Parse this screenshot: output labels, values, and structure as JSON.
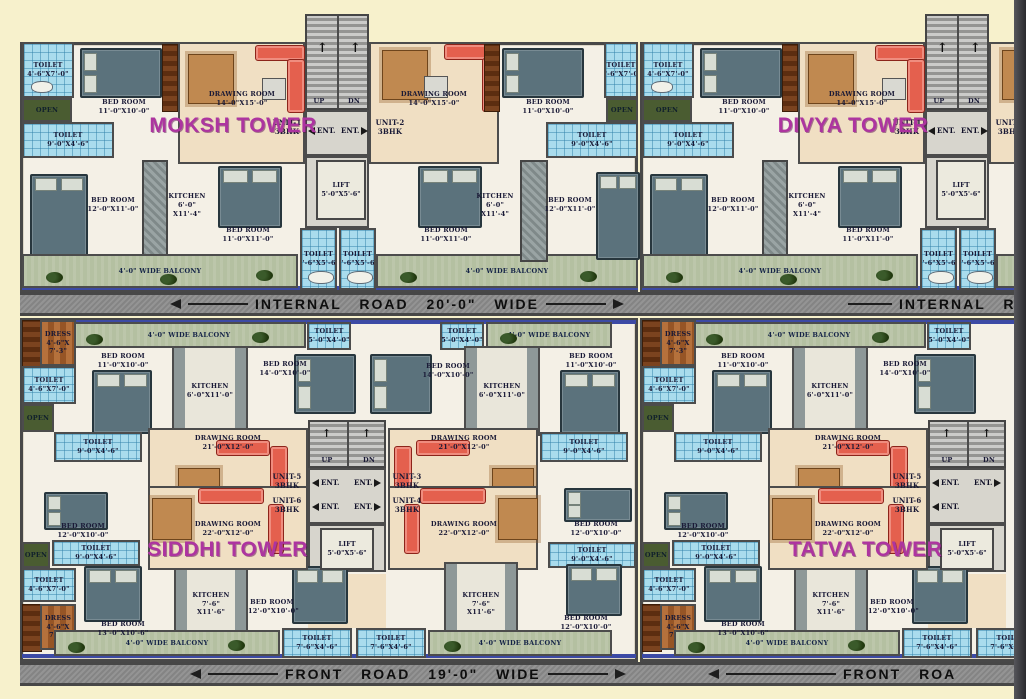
{
  "towers": {
    "moksh": "MOKSH TOWER",
    "divya": "DIVYA TOWER",
    "siddhi": "SIDDHI TOWER",
    "tatva": "TATVA TOWER"
  },
  "roads": {
    "internal": "INTERNAL ROAD 20'-0\" WIDE",
    "internal_cut": "INTERNAL ROAD",
    "front": "FRONT ROAD 19'-0\" WIDE",
    "front_cut": "FRONT ROA"
  },
  "common": {
    "balcony": "4'-0\" WIDE BALCONY",
    "open": "OPEN",
    "up": "UP",
    "dn": "DN",
    "ent": "ENT.",
    "lift": "LIFT",
    "lift_dim": "5'-0\"X5'-6\"",
    "bhk": "3BHK"
  },
  "units": {
    "u1": "UNIT-1",
    "u2": "UNIT-2",
    "u3": "UNIT-3",
    "u4": "UNIT-4",
    "u5": "UNIT-5",
    "u6": "UNIT-6"
  },
  "top": {
    "toilet_a": {
      "name": "TOILET",
      "dim": "4'-6\"X7'-0\""
    },
    "toilet_b": {
      "name": "TOILET",
      "dim": "9'-0\"X4'-6\""
    },
    "toilet_c": {
      "name": "TOILET",
      "dim": "4'-6\"X5'-6\""
    },
    "bed_a": {
      "name": "BED ROOM",
      "dim": "11'-0\"X10'-0\""
    },
    "bed_b": {
      "name": "BED ROOM",
      "dim": "12'-0\"X11'-0\""
    },
    "bed_c": {
      "name": "BED ROOM",
      "dim": "11'-0\"X11'-0\""
    },
    "drawing": {
      "name": "DRAWING ROOM",
      "dim": "14'-0\"X15'-0\""
    },
    "kitchen": {
      "name": "KITCHEN",
      "dim1": "6'-0\"",
      "dim2": "X11'-4\""
    }
  },
  "bottom": {
    "dress": {
      "name": "DRESS",
      "dim1": "4'-6\"X",
      "dim2": "7'-3\""
    },
    "toilet_a": {
      "name": "TOILET",
      "dim": "4'-6\"X7'-0\""
    },
    "toilet_b": {
      "name": "TOILET",
      "dim": "9'-0\"X4'-6\""
    },
    "toilet_c": {
      "name": "TOILET",
      "dim": "5'-0\"X4'-0\""
    },
    "toilet_d": {
      "name": "TOILET",
      "dim": "7'-6\"X4'-6\""
    },
    "bed_a": {
      "name": "BED ROOM",
      "dim": "11'-0\"X10'-0\""
    },
    "bed_b": {
      "name": "BED ROOM",
      "dim": "14'-0\"X10'-0\""
    },
    "bed_c": {
      "name": "BED ROOM",
      "dim": "12'-0\"X10'-0\""
    },
    "bed_d": {
      "name": "BED ROOM",
      "dim": "13'-0\"X10'-6\""
    },
    "kitchen_a": {
      "name": "KITCHEN",
      "dim": "6'-0\"X11'-0\""
    },
    "kitchen_b": {
      "name": "KITCHEN",
      "dim1": "7'-6\"",
      "dim2": "X11'-6\""
    },
    "drawing_a": {
      "name": "DRAWING ROOM",
      "dim": "21'-0\"X12'-0\""
    },
    "drawing_b": {
      "name": "DRAWING ROOM",
      "dim": "22'-0\"X12'-0\""
    }
  }
}
